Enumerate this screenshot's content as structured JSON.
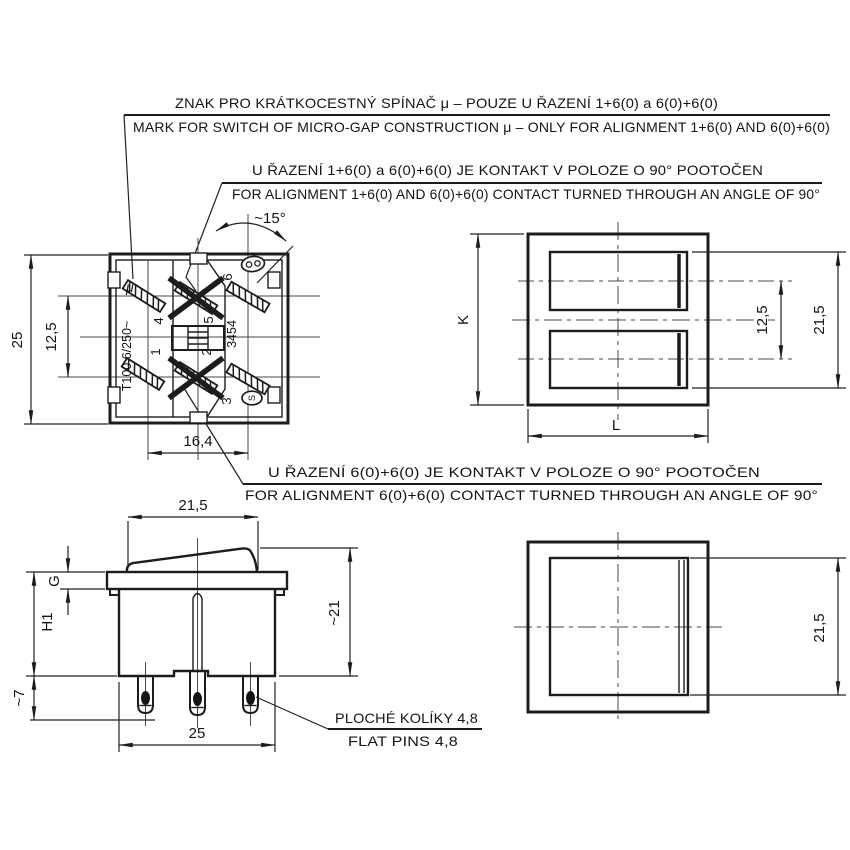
{
  "drawing": {
    "notes": {
      "mark_note_cz": "ZNAK PRO KRÁTKOCESTNÝ SPÍNAČ μ  –  POUZE U ŘAZENÍ 1+6(0) a 6(0)+6(0)",
      "mark_note_en": "MARK FOR SWITCH OF MICRO-GAP CONSTRUCTION μ  –  ONLY FOR ALIGNMENT 1+6(0) AND 6(0)+6(0)",
      "align_note1_cz": "U ŘAZENÍ  1+6(0) a 6(0)+6(0) JE KONTAKT V POLOZE O 90° POOTOČEN",
      "align_note1_en": "FOR ALIGNMENT 1+6(0) AND 6(0)+6(0) CONTACT TURNED THROUGH AN ANGLE OF 90°",
      "align_note2_cz": "U ŘAZENÍ 6(0)+6(0) JE KONTAKT V POLOZE O 90° POOTOČEN",
      "align_note2_en": "FOR ALIGNMENT 6(0)+6(0) CONTACT TURNED THROUGH AN ANGLE OF  90°",
      "pins_note_cz": "PLOCHÉ KOLÍKY 4,8",
      "pins_note_en": "FLAT PINS 4,8"
    },
    "terminal_view": {
      "symbol_micro_gap": "μ",
      "type_marking": "T100  6/250~",
      "code": "3454",
      "approval_mark": "S",
      "terminals": {
        "t1": "1",
        "t2": "2",
        "t3": "3",
        "t4": "4",
        "t5": "5",
        "t6": "6"
      },
      "dims": {
        "height": "25",
        "row_spacing": "12,5",
        "pin_spacing": "16,4",
        "pin_angle": "~15°"
      }
    },
    "housing_back_view": {
      "dims": {
        "height": "K",
        "width": "L",
        "window_spacing": "12,5",
        "window_span": "21,5"
      }
    },
    "side_view": {
      "dims": {
        "rocker_width": "21,5",
        "flange_thickness": "G",
        "body_height": "H1",
        "pin_length": "~7",
        "total_width": "25",
        "depth": "~21"
      }
    },
    "front_view": {
      "dims": {
        "window_height": "21,5"
      }
    },
    "colors": {
      "line": "#1c1c1c",
      "background": "#ffffff"
    }
  }
}
